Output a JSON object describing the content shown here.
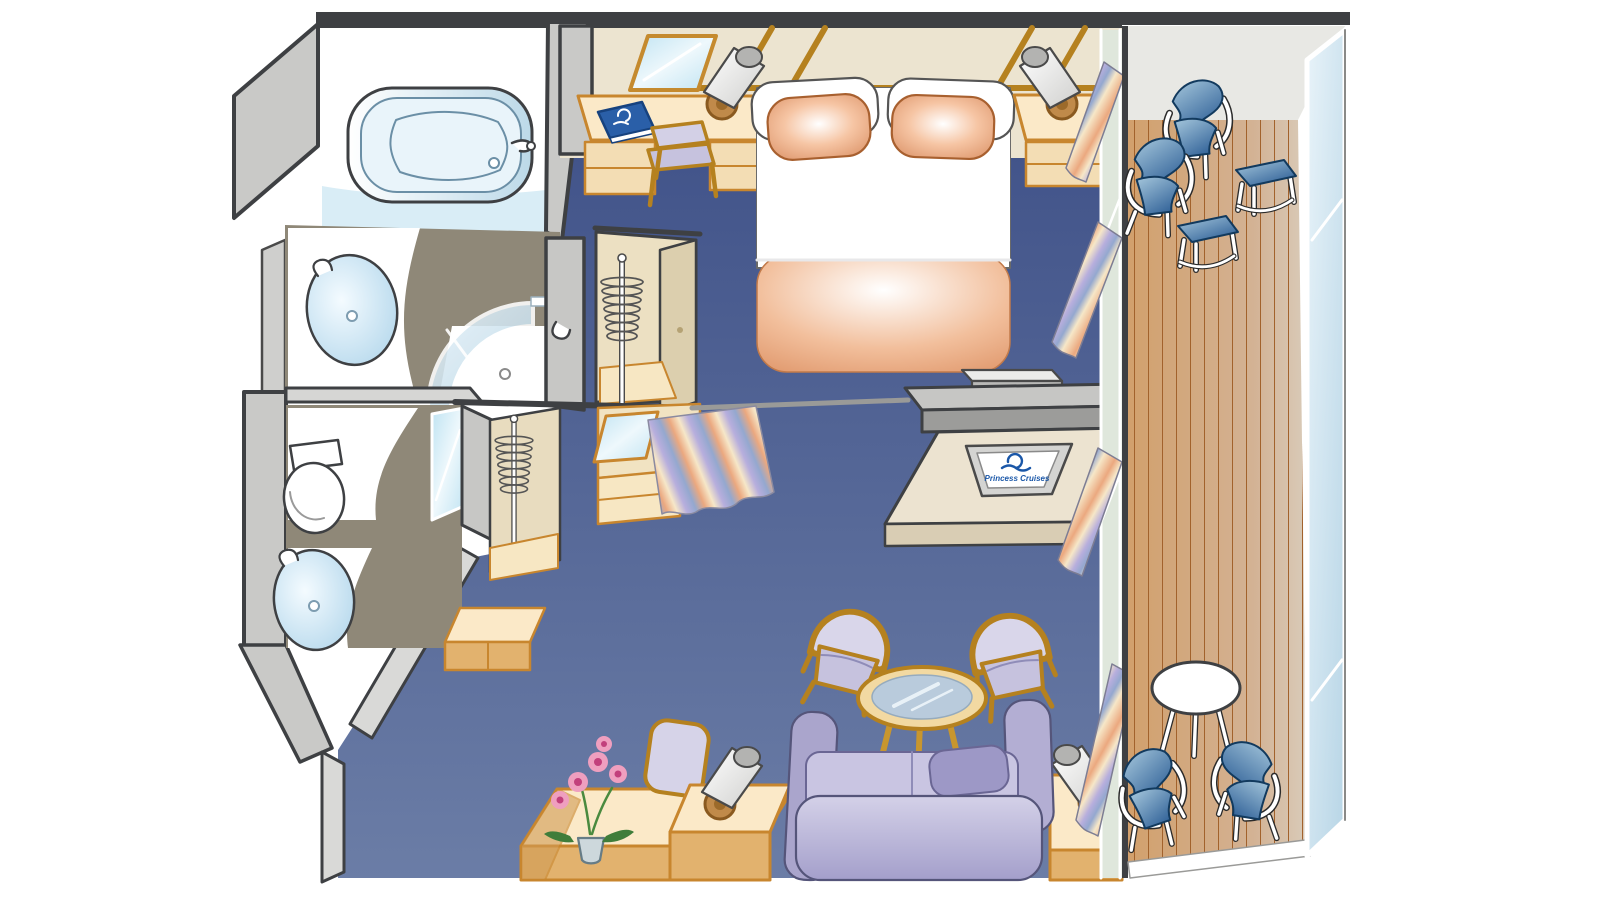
{
  "title": "Cruise ship suite with balcony — isometric cutaway floor plan",
  "brand": {
    "tv_label": "Princess Cruises",
    "logo_icon": "princess-cruises-seawitch-logo"
  },
  "palette": {
    "outline": "#3e4043",
    "carpet_blue": "#4a5d8e",
    "wall_beige": "#ece4d0",
    "trim_brown": "#b5811f",
    "furniture_beige_top": "#fbe9c8",
    "furniture_beige_side": "#e2b26e",
    "wall_gray_outer": "#c9c9c7",
    "wall_gray_inner": "#e3e3df",
    "bath_floor_taupe": "#8f8878",
    "fixture_blue": "#cfe6f2",
    "pillow_peach": "#e9a878",
    "upholstery_lavender": "#c6c2de",
    "sofa_lavender": "#b3aed3",
    "tv_logo_blue": "#1a57a8",
    "deck_wood": "#d2a06c",
    "deck_line": "#a2622c",
    "balcony_chair_blue": "#2e5f96",
    "railing_glass": "#d8ebf4",
    "curtain_peach": "#eba87f",
    "curtain_lavender": "#b7aedd",
    "orchid_pink": "#e4769f"
  },
  "rooms": [
    {
      "name": "bathroom",
      "items": [
        "bathtub",
        "tub-faucet",
        "washbasin",
        "shower-enclosure",
        "shower-head",
        "tile-floor"
      ]
    },
    {
      "name": "toilet-room",
      "items": [
        "toilet",
        "washbasin",
        "wall-mirror"
      ]
    },
    {
      "name": "dressing-area",
      "items": [
        "wardrobe-closet",
        "clothes-rail",
        "second-clothes-rail",
        "vanity-with-mirror",
        "striped-curtain",
        "luggage-bench"
      ]
    },
    {
      "name": "bedroom",
      "items": [
        "queen-bed",
        "white-pillows",
        "peach-pillows",
        "foot-blanket",
        "bedside-lamp-left",
        "bedside-lamp-right",
        "nightstand",
        "desk",
        "desk-chair",
        "wall-mirror",
        "blue-guest-book",
        "gray-bench"
      ]
    },
    {
      "name": "media-wall",
      "items": [
        "divider-shelf",
        "tv-cabinet",
        "flat-tv"
      ]
    },
    {
      "name": "living-room",
      "items": [
        "sofa",
        "armchair-left",
        "armchair-right",
        "glass-coffee-table",
        "side-table-left",
        "side-table-right",
        "table-lamp-left",
        "table-lamp-right",
        "writing-desk",
        "writing-chair",
        "orchid-plant"
      ]
    },
    {
      "name": "balcony",
      "items": [
        "wood-deck",
        "deck-chair-1",
        "deck-chair-2",
        "footstool-1",
        "footstool-2",
        "round-table",
        "deck-chair-3",
        "deck-chair-4",
        "glass-railing"
      ]
    }
  ]
}
